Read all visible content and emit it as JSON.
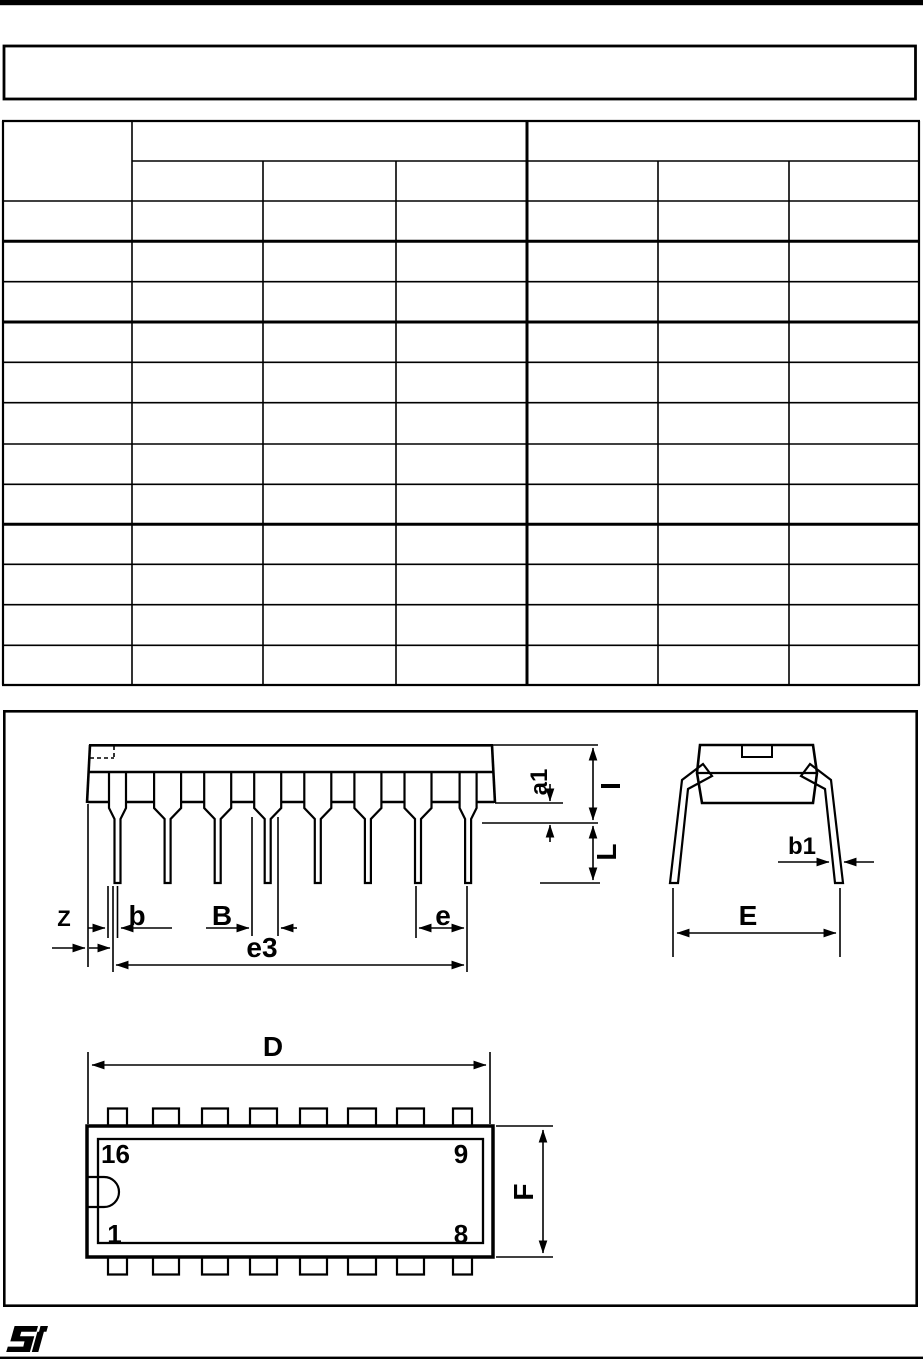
{
  "page": {
    "background": "#ffffff",
    "ink": "#000000"
  },
  "title_box": {
    "text": ""
  },
  "spec_table": {
    "corner_header": "",
    "group_headers": [
      "",
      ""
    ],
    "sub_headers": [
      "",
      "",
      "",
      "",
      "",
      ""
    ],
    "rows": [
      [
        "",
        "",
        "",
        "",
        "",
        "",
        ""
      ],
      [
        "",
        "",
        "",
        "",
        "",
        "",
        ""
      ],
      [
        "",
        "",
        "",
        "",
        "",
        "",
        ""
      ],
      [
        "",
        "",
        "",
        "",
        "",
        "",
        ""
      ],
      [
        "",
        "",
        "",
        "",
        "",
        "",
        ""
      ],
      [
        "",
        "",
        "",
        "",
        "",
        "",
        ""
      ],
      [
        "",
        "",
        "",
        "",
        "",
        "",
        ""
      ],
      [
        "",
        "",
        "",
        "",
        "",
        "",
        ""
      ],
      [
        "",
        "",
        "",
        "",
        "",
        "",
        ""
      ],
      [
        "",
        "",
        "",
        "",
        "",
        "",
        ""
      ],
      [
        "",
        "",
        "",
        "",
        "",
        "",
        ""
      ],
      [
        "",
        "",
        "",
        "",
        "",
        "",
        ""
      ]
    ]
  },
  "figure": {
    "side_view": {
      "dim_labels": {
        "z": "Z",
        "b": "b",
        "b_upper": "B",
        "e": "e",
        "e3": "e3",
        "a1": "a1",
        "i": "I",
        "l": "L"
      }
    },
    "end_view": {
      "dim_labels": {
        "b1": "b1",
        "e_upper": "E"
      }
    },
    "plan_view": {
      "dim_labels": {
        "d": "D",
        "f": "F"
      },
      "pin_numbers": {
        "top_left": "16",
        "top_right": "9",
        "bottom_left": "1",
        "bottom_right": "8"
      }
    }
  },
  "footer": {
    "logo": "st-logo"
  }
}
